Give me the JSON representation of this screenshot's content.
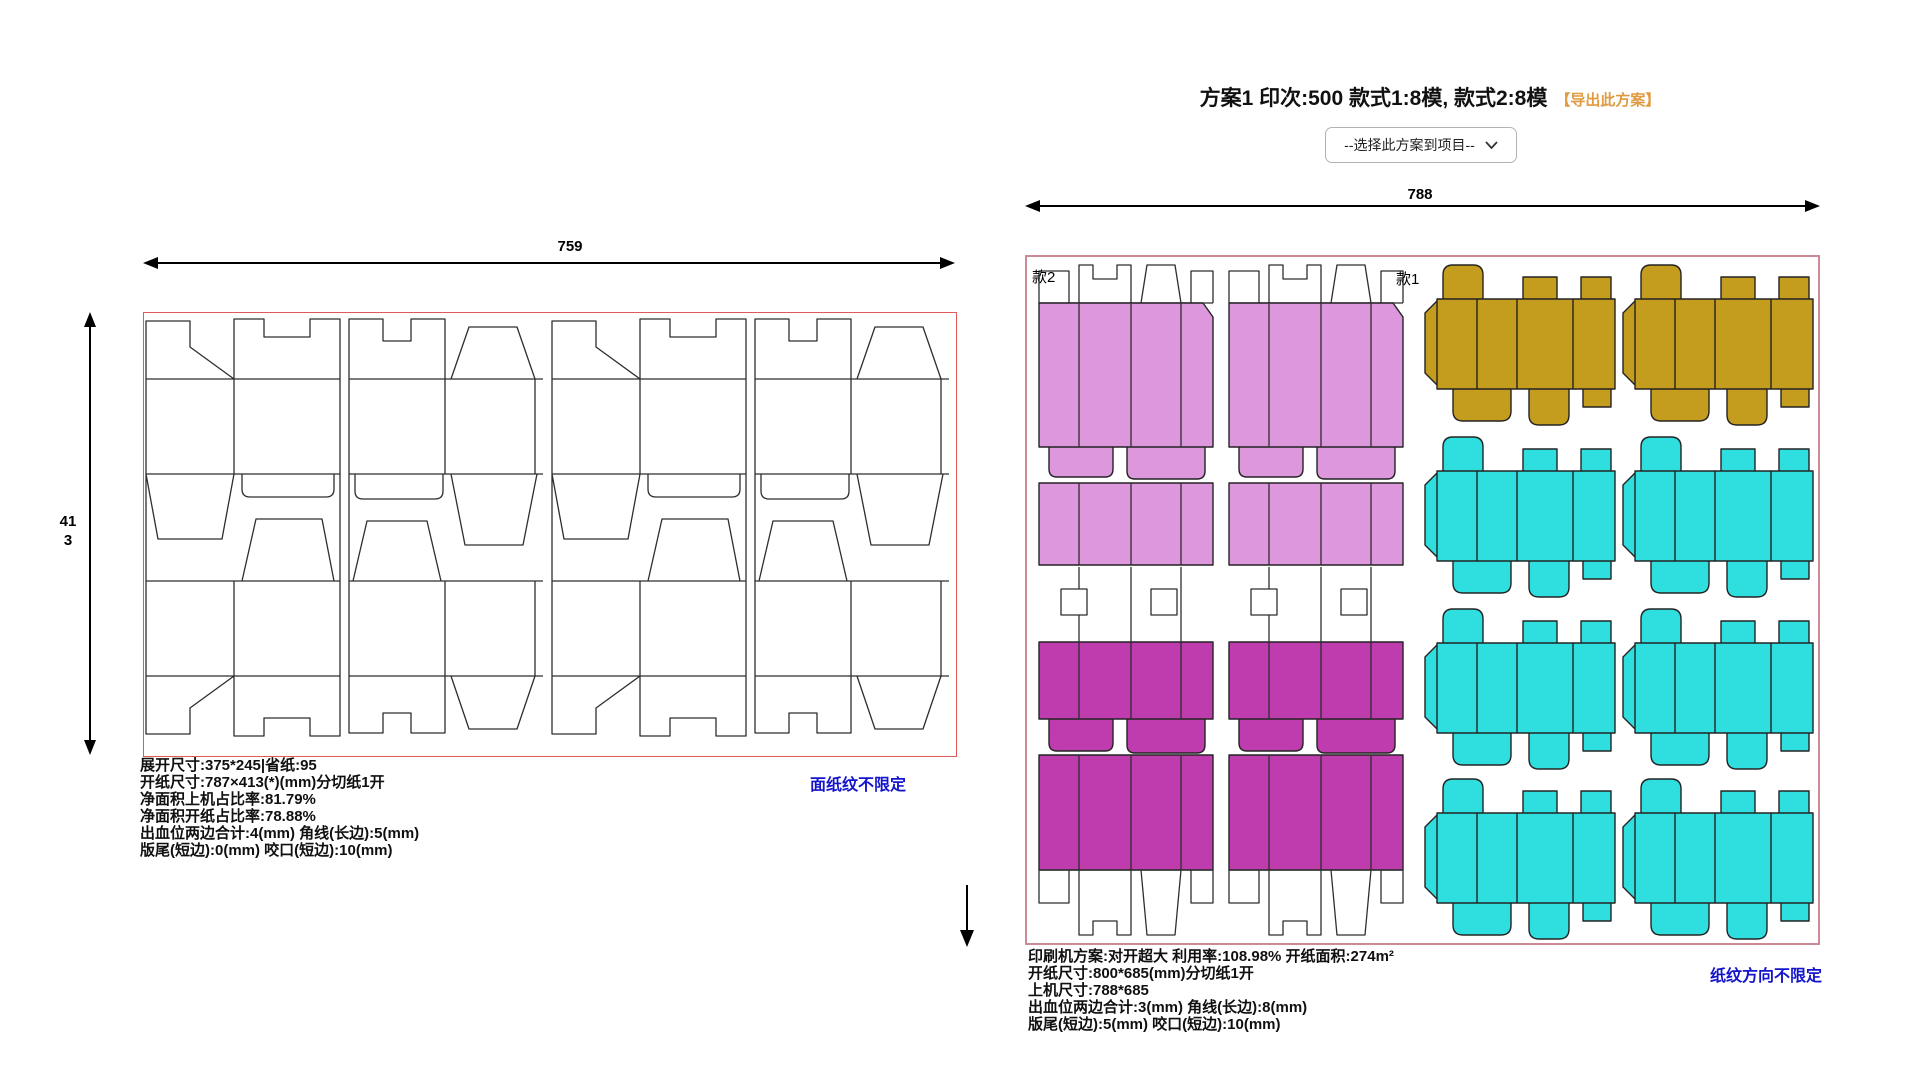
{
  "plan_header": {
    "title": "方案1 印次:500 款式1:8模, 款式2:8模",
    "export_link": "【导出此方案】",
    "project_select": {
      "value": "--选择此方案到项目--"
    }
  },
  "left_sheet": {
    "width_dim": "759",
    "height_dim": "413",
    "grain_note": "面纸纹不限定",
    "info_lines": [
      "展开尺寸:375*245|省纸:95",
      "开纸尺寸:787×413(*)(mm)分切纸1开",
      "净面积上机占比率:81.79%",
      "净面积开纸占比率:78.88%",
      "出血位两边合计:4(mm) 角线(长边):5(mm)",
      "版尾(短边):0(mm) 咬口(短边):10(mm)"
    ]
  },
  "right_sheet": {
    "width_dim": "788",
    "style1_label": "款1",
    "style2_label": "款2",
    "grain_note": "纸纹方向不限定",
    "info_lines": [
      "印刷机方案:对开超大 利用率:108.98% 开纸面积:274m²",
      "开纸尺寸:800*685(mm)分切纸1开",
      "上机尺寸:788*685",
      "出血位两边合计:3(mm) 角线(长边):8(mm)",
      "版尾(短边):5(mm) 咬口(短边):10(mm)"
    ]
  },
  "colors": {
    "light_pink": "#DD97DC",
    "magenta": "#BE3CAD",
    "cyan": "#2FDFDF",
    "gold": "#C49C1E",
    "left_border": "#E05A5A",
    "right_border": "#CC8B96",
    "note_blue": "#1414CC",
    "link_orange": "#E09A40"
  }
}
